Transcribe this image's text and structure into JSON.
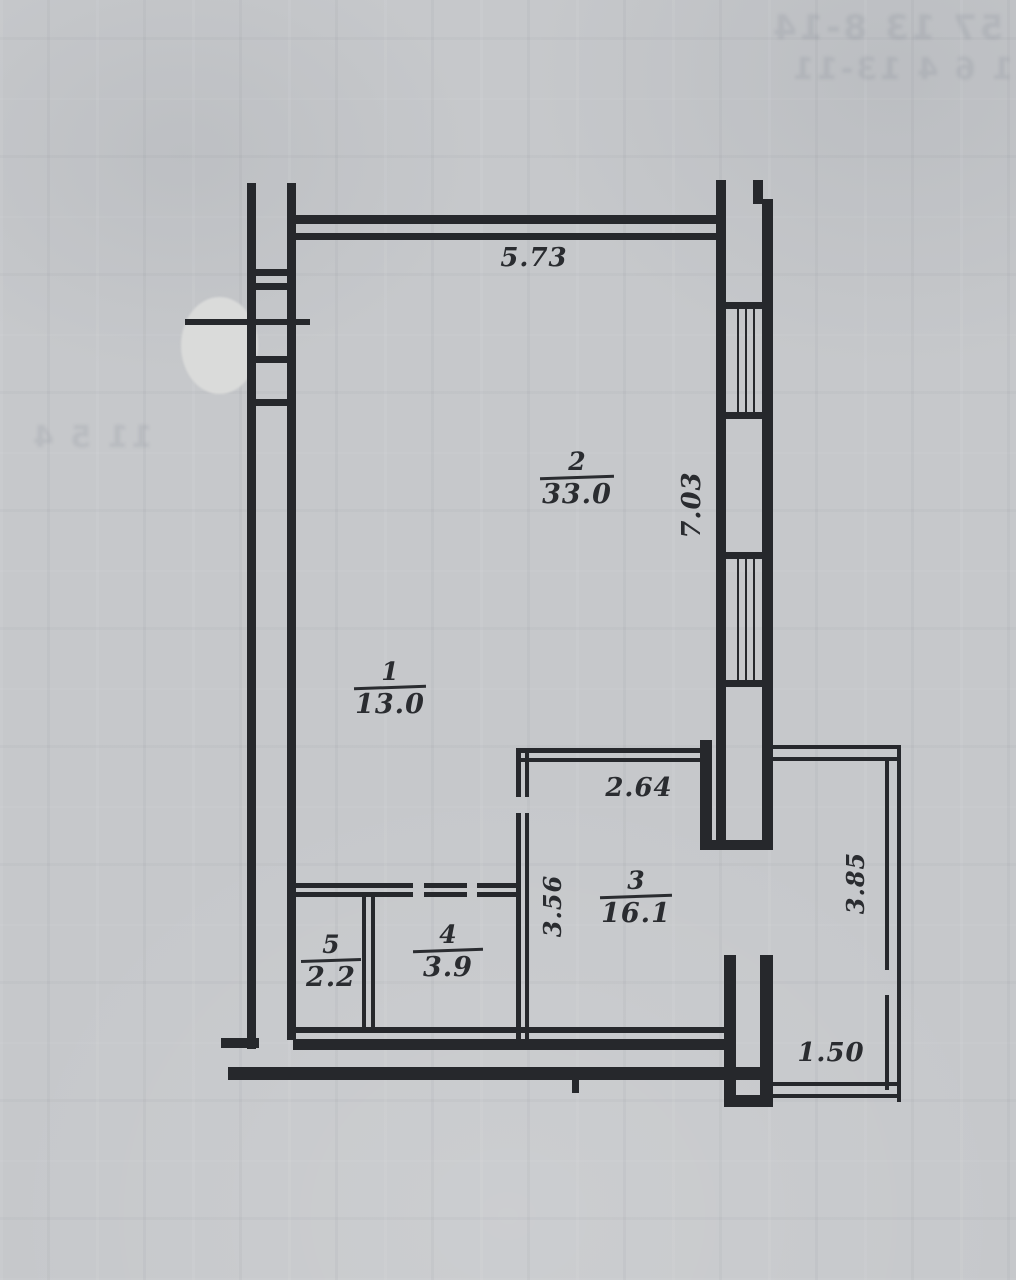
{
  "rooms": [
    {
      "number": "1",
      "area": "13.0"
    },
    {
      "number": "2",
      "area": "33.0"
    },
    {
      "number": "3",
      "area": "16.1"
    },
    {
      "number": "4",
      "area": "3.9"
    },
    {
      "number": "5",
      "area": "2.2"
    }
  ],
  "dimensions": {
    "top_width": "5.73",
    "right_height": "7.03",
    "room3_top": "2.64",
    "room3_left": "3.56",
    "balcony_right": "3.85",
    "balcony_bottom": "1.50"
  },
  "colors": {
    "ink": "#26282c",
    "paper": "#c6c8cb",
    "stamp_cover": "#dadbda"
  }
}
